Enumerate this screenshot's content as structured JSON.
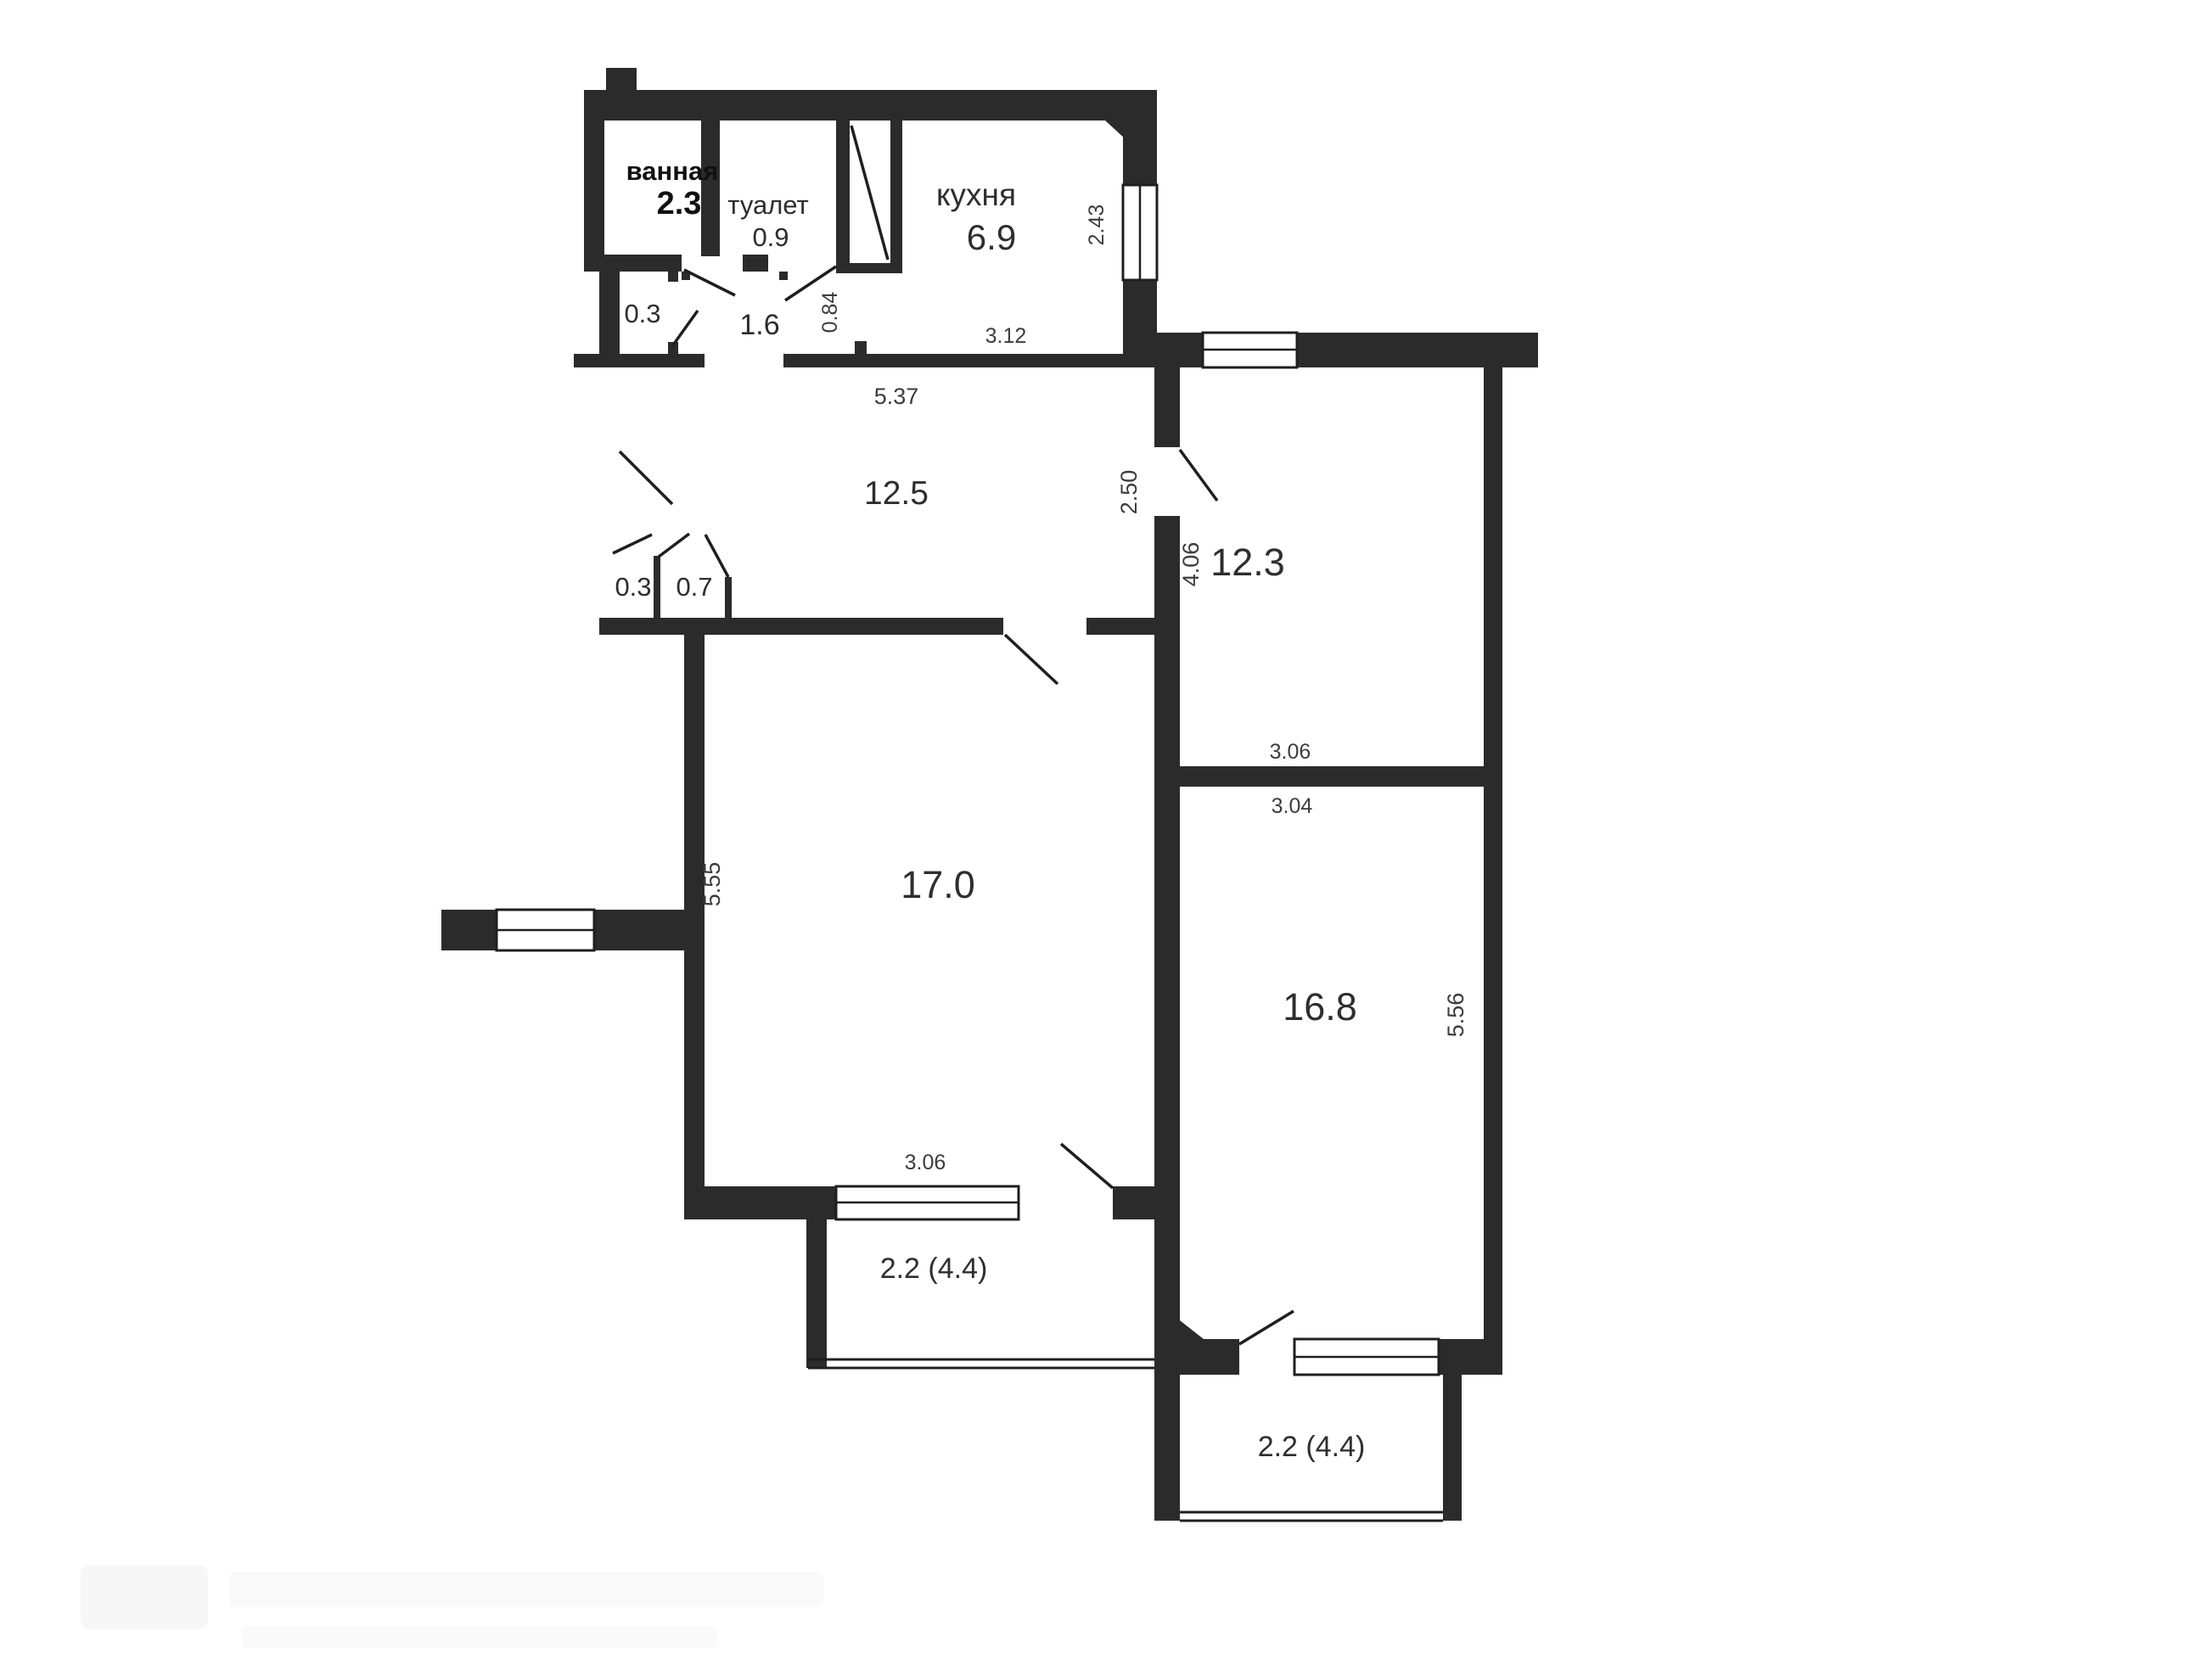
{
  "meta": {
    "background": "#ffffff",
    "wall_color": "#2b2b2b",
    "line_color": "#1f1f1f",
    "text_color": "#2e2e2e"
  },
  "rooms": {
    "bathroom": {
      "name": "ванная",
      "area": "2.3"
    },
    "toilet": {
      "name": "туалет",
      "area": "0.9"
    },
    "kitchen": {
      "name": "кухня",
      "area": "6.9"
    },
    "closet_entry": {
      "area": "0.3"
    },
    "hall": {
      "area": "1.6"
    },
    "corridor": {
      "area": "12.5"
    },
    "closet_a": {
      "area": "0.3"
    },
    "closet_b": {
      "area": "0.7"
    },
    "room_a": {
      "area": "12.3"
    },
    "room_b": {
      "area": "17.0"
    },
    "room_c": {
      "area": "16.8"
    },
    "balcony_left": {
      "area": "2.2 (4.4)"
    },
    "balcony_right": {
      "area": "2.2 (4.4)"
    }
  },
  "dimensions": {
    "kitchen_depth": "2.43",
    "kitchen_width": "3.12",
    "hall_passage": "0.84",
    "corridor_width": "5.37",
    "room_a_entry": "2.50",
    "room_a_depth": "4.06",
    "room_a_width": "3.06",
    "room_c_width": "3.04",
    "room_b_depth": "5.55",
    "room_c_depth": "5.56",
    "balcony_left_width": "3.06"
  },
  "watermark": {
    "icon": "agency-logo"
  }
}
